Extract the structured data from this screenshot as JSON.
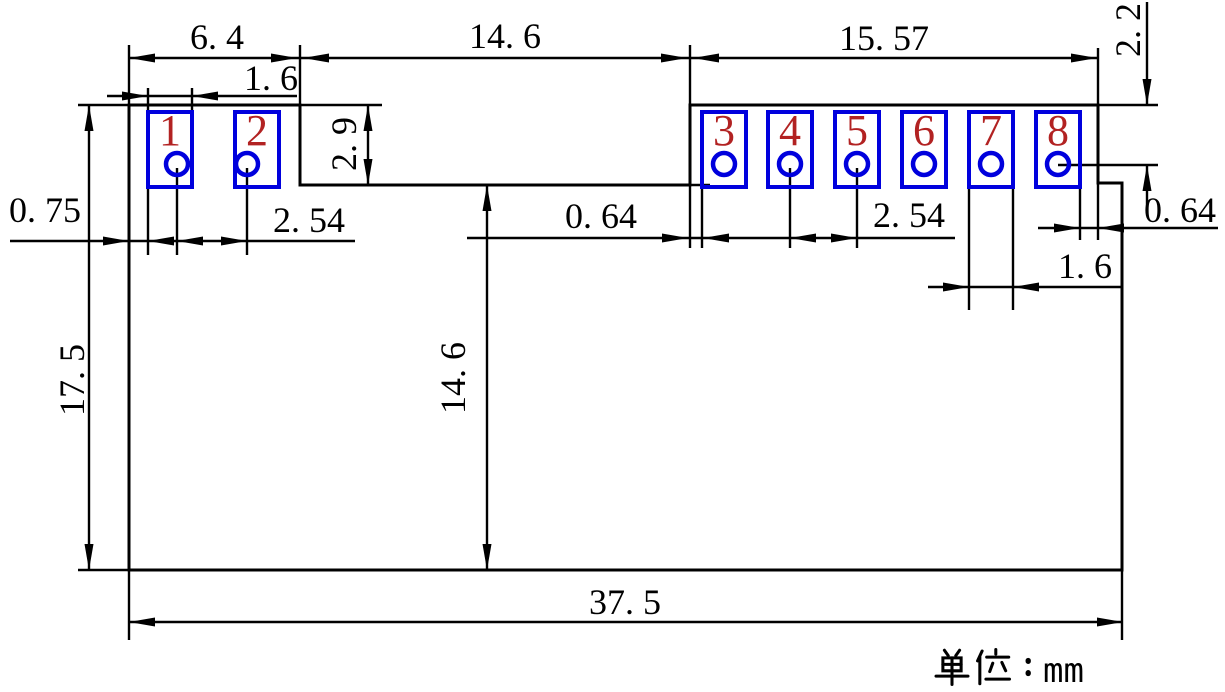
{
  "canvas": {
    "width": 1225,
    "height": 692
  },
  "unit_note": "单位：mm",
  "colors": {
    "line": "#000000",
    "pad_outline": "#0000dd",
    "pad_number": "#b22222",
    "background": "#ffffff",
    "label_text": "#000000"
  },
  "board_outline_points": "129,105 300,105 300,185 690,185 690,105 1098,105 1098,183 1122,183 1122,570 129,570",
  "pads": {
    "y": 112,
    "width": 44,
    "height": 75,
    "hole_cy": 164,
    "hole_r": 11,
    "items": [
      {
        "number": "1",
        "x": 148,
        "hole_cx": 177
      },
      {
        "number": "2",
        "x": 235,
        "hole_cx": 247
      },
      {
        "number": "3",
        "x": 702,
        "hole_cx": 724
      },
      {
        "number": "4",
        "x": 768,
        "hole_cx": 790
      },
      {
        "number": "5",
        "x": 835,
        "hole_cx": 857
      },
      {
        "number": "6",
        "x": 902,
        "hole_cx": 924
      },
      {
        "number": "7",
        "x": 969,
        "hole_cx": 991
      },
      {
        "number": "8",
        "x": 1036,
        "hole_cx": 1058
      }
    ]
  },
  "extension_lines": [
    [
      78,
      105,
      129,
      105
    ],
    [
      300,
      105,
      382,
      105
    ],
    [
      1098,
      105,
      1158,
      105
    ],
    [
      690,
      185,
      710,
      185
    ],
    [
      78,
      570,
      129,
      570
    ],
    [
      1058,
      165,
      1158,
      165
    ],
    [
      129,
      45,
      129,
      105
    ],
    [
      129,
      570,
      129,
      640
    ],
    [
      300,
      45,
      300,
      105
    ],
    [
      690,
      45,
      690,
      105
    ],
    [
      690,
      185,
      690,
      248
    ],
    [
      1098,
      48,
      1098,
      105
    ],
    [
      1098,
      183,
      1098,
      240
    ],
    [
      1122,
      570,
      1122,
      640
    ],
    [
      148,
      88,
      148,
      110
    ],
    [
      192,
      88,
      192,
      110
    ],
    [
      148,
      187,
      148,
      255
    ],
    [
      177,
      168,
      177,
      255
    ],
    [
      247,
      168,
      247,
      255
    ],
    [
      702,
      187,
      702,
      248
    ],
    [
      790,
      168,
      790,
      248
    ],
    [
      857,
      168,
      857,
      248
    ],
    [
      969,
      187,
      969,
      310
    ],
    [
      1013,
      187,
      1013,
      310
    ],
    [
      1080,
      187,
      1080,
      240
    ]
  ],
  "dimension_lines": [
    [
      129,
      58,
      1097,
      58
    ],
    [
      107,
      96,
      297,
      96
    ],
    [
      10,
      241,
      355,
      241
    ],
    [
      467,
      238,
      955,
      238
    ],
    [
      1038,
      228,
      1218,
      228
    ],
    [
      928,
      287,
      1122,
      287
    ],
    [
      129,
      622,
      1123,
      622
    ],
    [
      89,
      105,
      89,
      570
    ],
    [
      487,
      185,
      487,
      570
    ],
    [
      368,
      105,
      368,
      185
    ],
    [
      1147,
      2,
      1147,
      105
    ],
    [
      1147,
      165,
      1147,
      207
    ]
  ],
  "arrows": [
    [
      129,
      58,
      "left"
    ],
    [
      297,
      58,
      "right"
    ],
    [
      303,
      58,
      "left"
    ],
    [
      687,
      58,
      "right"
    ],
    [
      693,
      58,
      "left"
    ],
    [
      1097,
      58,
      "right"
    ],
    [
      148,
      96,
      "right"
    ],
    [
      192,
      96,
      "left"
    ],
    [
      129,
      241,
      "right"
    ],
    [
      148,
      241,
      "left"
    ],
    [
      177,
      241,
      "left"
    ],
    [
      247,
      241,
      "right"
    ],
    [
      688,
      238,
      "right"
    ],
    [
      703,
      238,
      "left"
    ],
    [
      790,
      238,
      "left"
    ],
    [
      857,
      238,
      "right"
    ],
    [
      1080,
      228,
      "right"
    ],
    [
      1098,
      228,
      "left"
    ],
    [
      969,
      287,
      "right"
    ],
    [
      1013,
      287,
      "left"
    ],
    [
      129,
      622,
      "left"
    ],
    [
      1123,
      622,
      "right"
    ],
    [
      89,
      105,
      "up"
    ],
    [
      89,
      570,
      "down"
    ],
    [
      487,
      185,
      "up"
    ],
    [
      487,
      570,
      "down"
    ],
    [
      368,
      105,
      "up"
    ],
    [
      368,
      185,
      "down"
    ],
    [
      1147,
      105,
      "down"
    ],
    [
      1147,
      165,
      "up"
    ]
  ],
  "dim_labels": [
    {
      "text": "6. 4",
      "x": 217,
      "y": 49,
      "rotate": 0
    },
    {
      "text": "14. 6",
      "x": 505,
      "y": 48,
      "rotate": 0
    },
    {
      "text": "15. 57",
      "x": 884,
      "y": 50,
      "rotate": 0
    },
    {
      "text": "2. 2",
      "x": 1140,
      "y": 30,
      "rotate": -90
    },
    {
      "text": "1. 6",
      "x": 271,
      "y": 90,
      "rotate": 0
    },
    {
      "text": "2. 9",
      "x": 356,
      "y": 144,
      "rotate": -90
    },
    {
      "text": "0. 75",
      "x": 45,
      "y": 222,
      "rotate": 0
    },
    {
      "text": "2. 54",
      "x": 309,
      "y": 232,
      "rotate": 0
    },
    {
      "text": "0. 64",
      "x": 601,
      "y": 228,
      "rotate": 0
    },
    {
      "text": "2. 54",
      "x": 909,
      "y": 227,
      "rotate": 0
    },
    {
      "text": "0. 64",
      "x": 1180,
      "y": 222,
      "rotate": 0
    },
    {
      "text": "1. 6",
      "x": 1085,
      "y": 278,
      "rotate": 0
    },
    {
      "text": "17. 5",
      "x": 84,
      "y": 380,
      "rotate": -90
    },
    {
      "text": "14. 6",
      "x": 465,
      "y": 378,
      "rotate": -90
    },
    {
      "text": "37. 5",
      "x": 625,
      "y": 614,
      "rotate": 0
    }
  ]
}
